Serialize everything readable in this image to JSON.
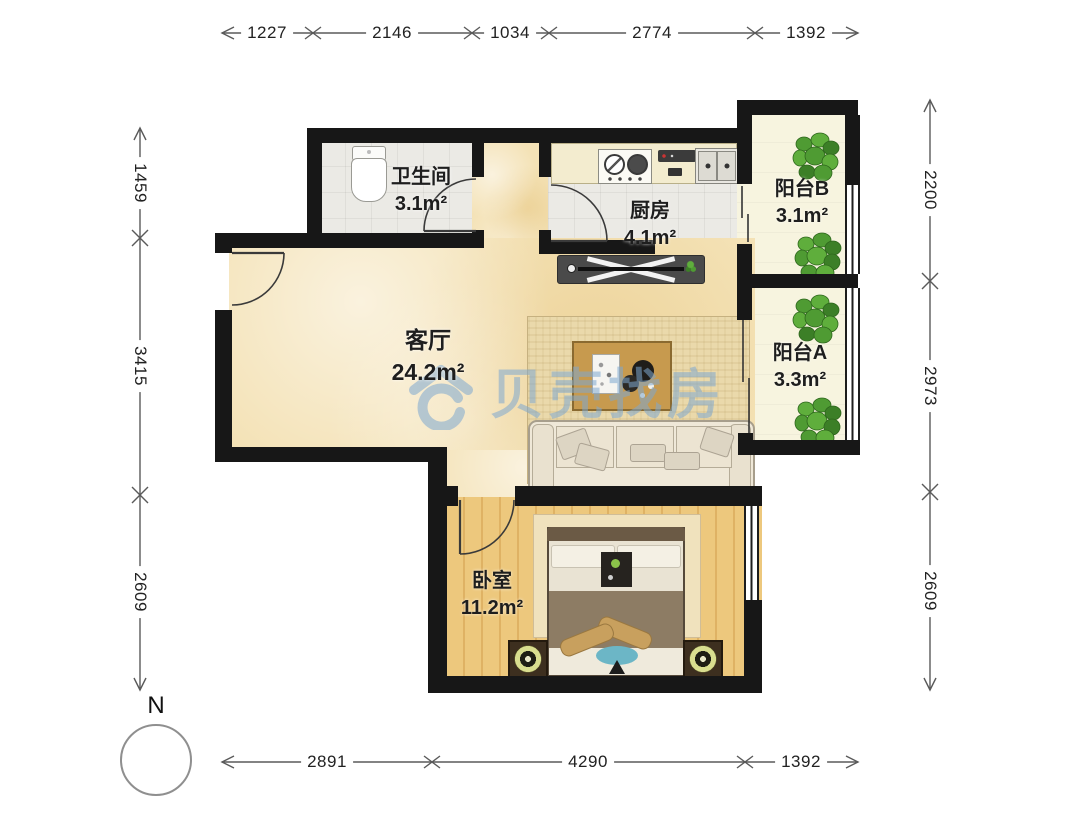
{
  "document": {
    "type": "residential floor plan"
  },
  "watermark": {
    "text": "贝壳找房"
  },
  "compass": {
    "label": "N"
  },
  "rooms": [
    {
      "id": "bathroom",
      "name": "卫生间",
      "area": "3.1m²"
    },
    {
      "id": "kitchen",
      "name": "厨房",
      "area": "4.1m²"
    },
    {
      "id": "balcony-b",
      "name": "阳台B",
      "area": "3.1m²"
    },
    {
      "id": "balcony-a",
      "name": "阳台A",
      "area": "3.3m²"
    },
    {
      "id": "living-room",
      "name": "客厅",
      "area": "24.2m²"
    },
    {
      "id": "bedroom",
      "name": "卧室",
      "area": "11.2m²"
    }
  ],
  "dimensions_mm": {
    "top": [
      "1227",
      "2146",
      "1034",
      "2774",
      "1392"
    ],
    "bottom": [
      "2891",
      "4290",
      "1392"
    ],
    "left": [
      "1459",
      "3415",
      "2609"
    ],
    "right": [
      "2200",
      "2973",
      "2609"
    ]
  },
  "colors": {
    "wall": "#171717",
    "living_floor": "#f4e2b6",
    "wood_floor": "#eac371",
    "tile_floor": "#ebeae5",
    "balcony_floor": "#f7f4df",
    "watermark_blue": "#7da8d0",
    "plant_green": "#4f9b33",
    "dimension_text": "#222222"
  }
}
